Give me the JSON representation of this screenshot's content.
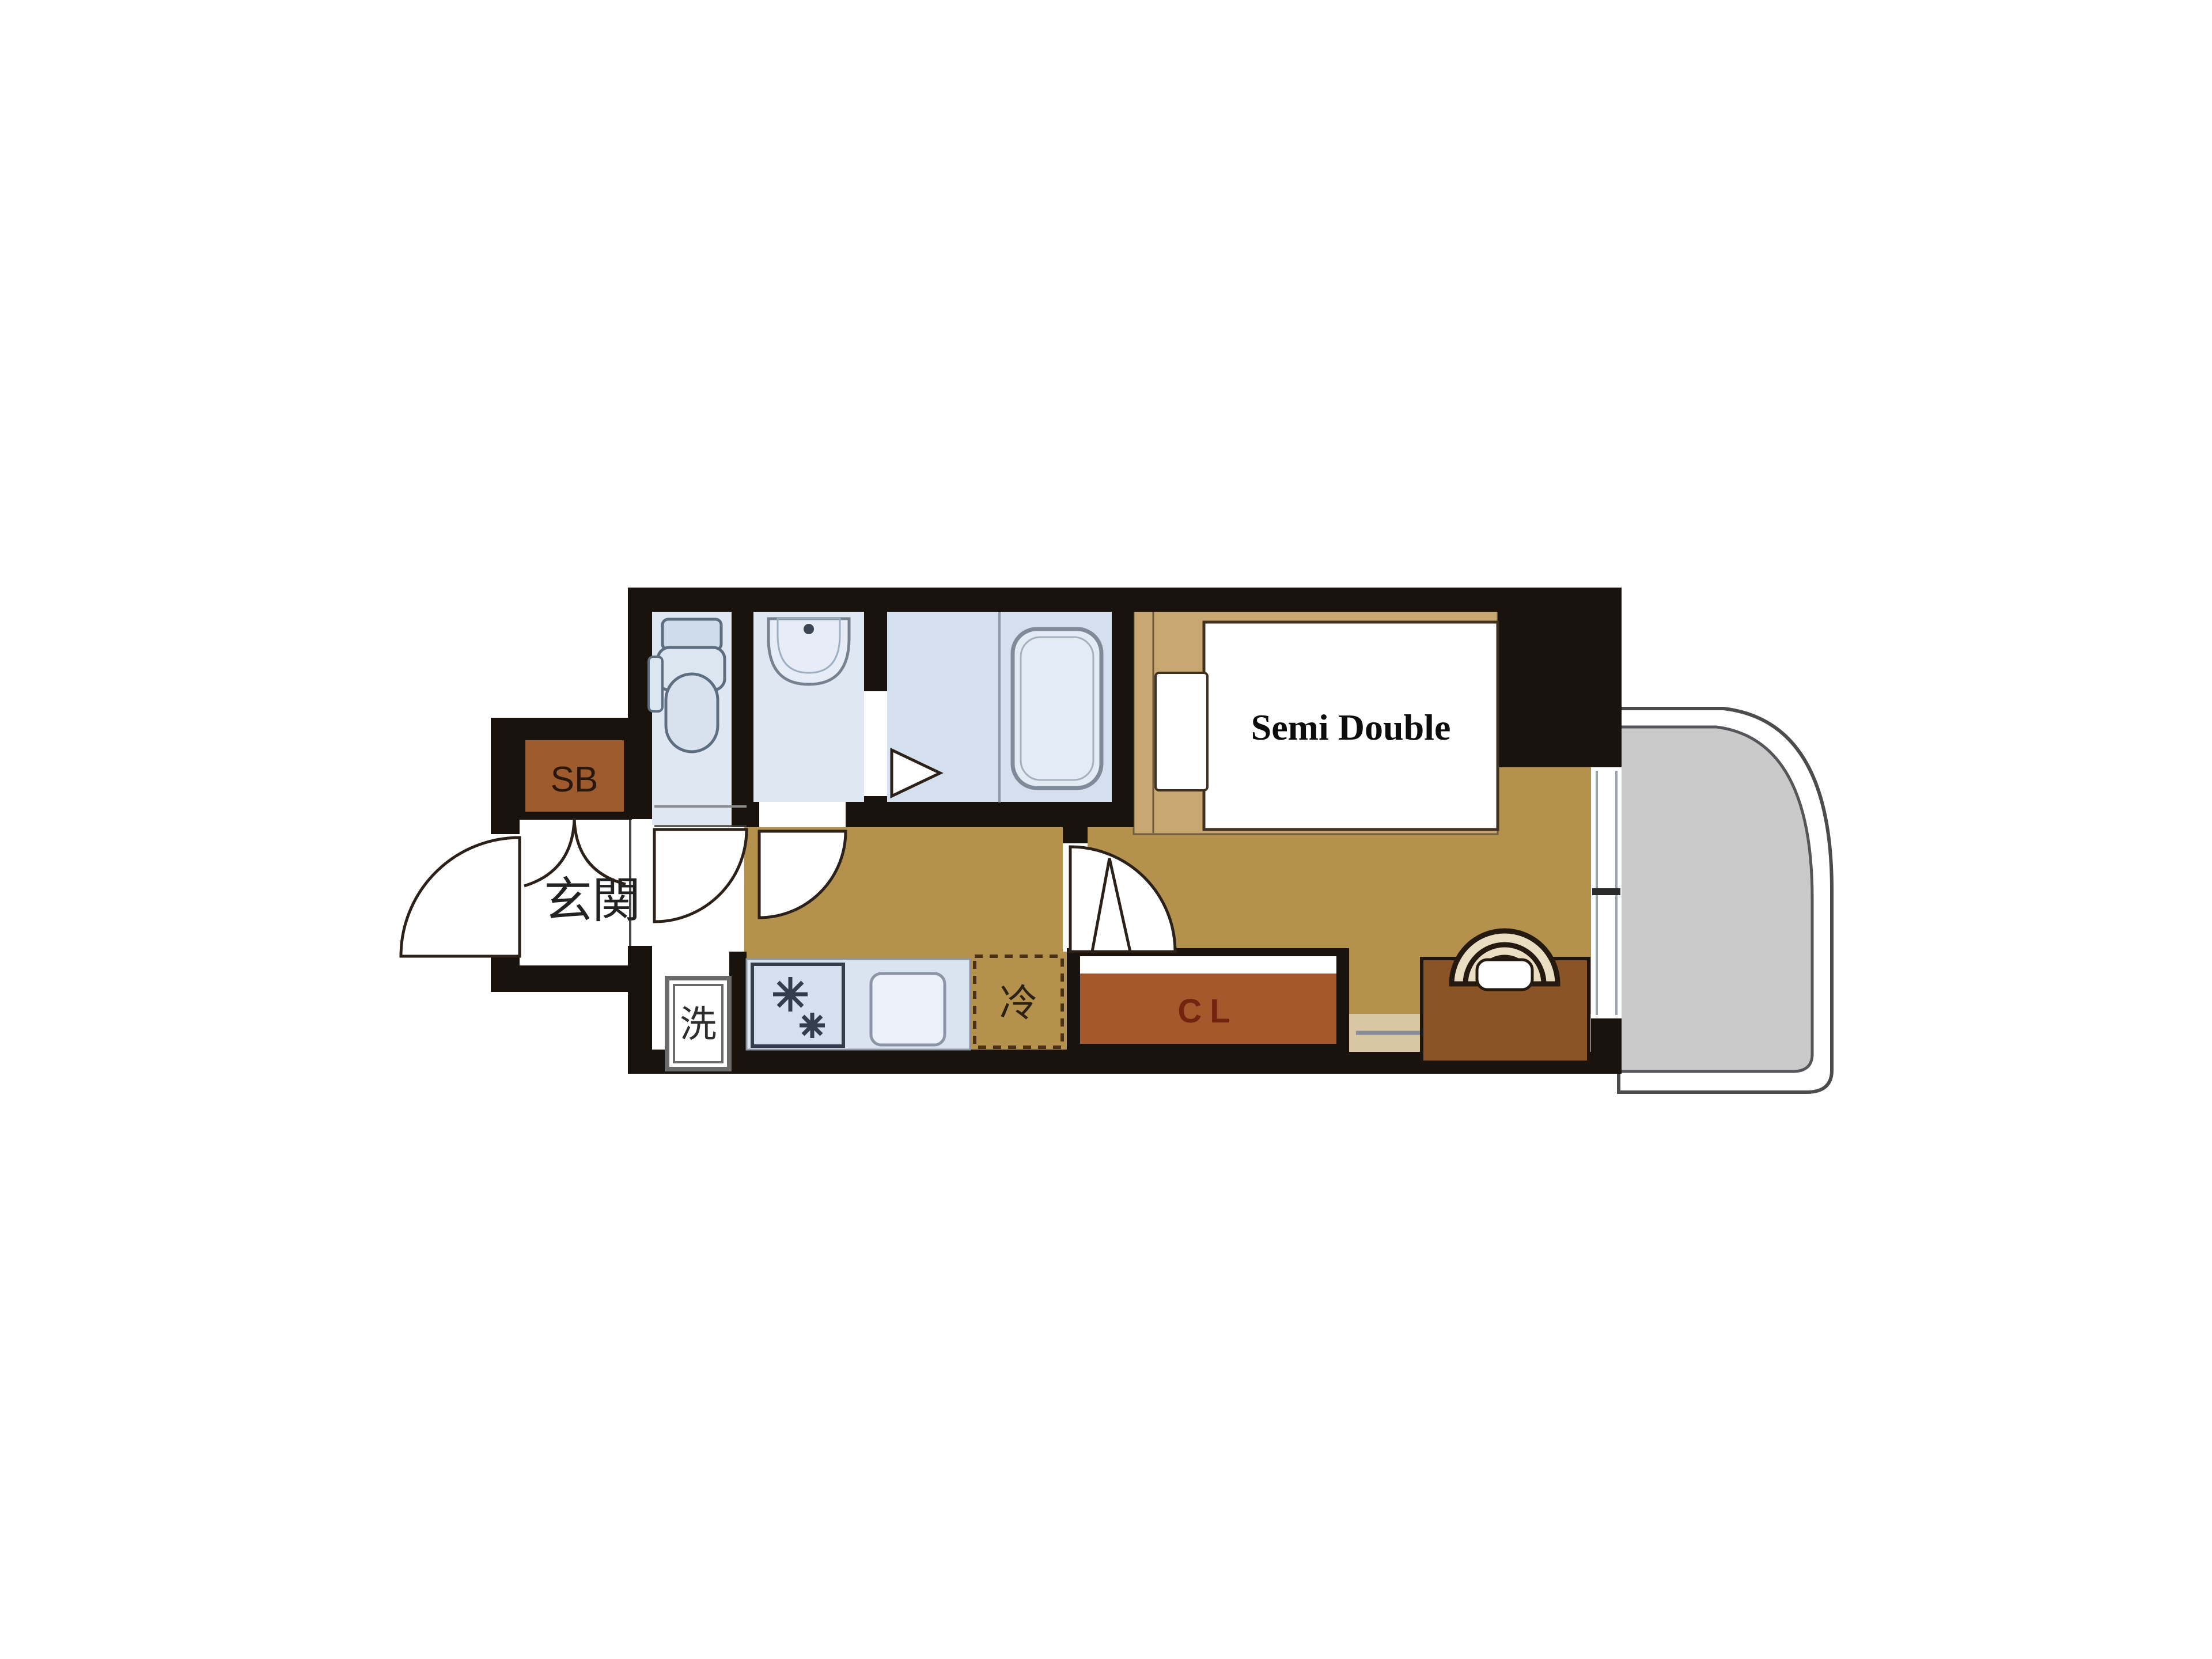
{
  "type": "floor_plan",
  "unit_labels": {
    "shoe_box": "SB",
    "entrance": "玄関",
    "washer": "洗",
    "fridge": "冷",
    "closet": "CL",
    "bed": "Semi Double"
  },
  "palette": {
    "wall": "#1a120c",
    "wood_floor": "#b4924e",
    "bed_platform": "#c9a771",
    "wet_room_floor": "#dfe8f2",
    "bathroom_floor": "#d4e0ed",
    "kitchen_counter": "#d9e4f0",
    "shoe_box_brown": "#9d5b2e",
    "closet_brown": "#a4582c",
    "closet_text": "#73240f",
    "desk_brown": "#8a5426",
    "window_sill": "#d8c7a2",
    "balcony_gray": "#c9c9c9",
    "fixture_outline": "#5d6e80"
  }
}
